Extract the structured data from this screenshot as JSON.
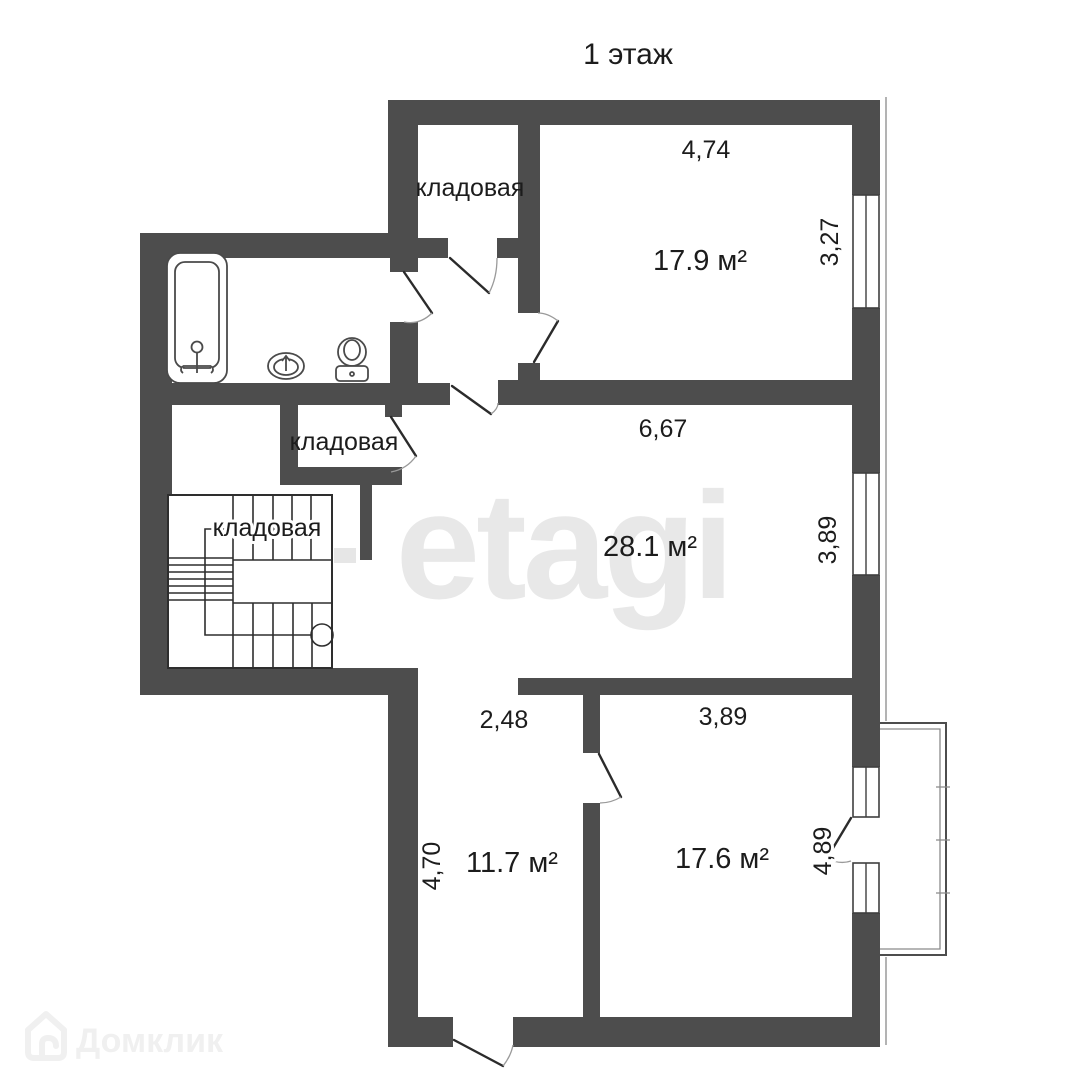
{
  "page": {
    "title": "1 этаж"
  },
  "plan": {
    "rooms": {
      "storage_top": {
        "label": "кладовая"
      },
      "storage_mid": {
        "label": "кладовая"
      },
      "storage_under_stairs": {
        "label": "кладовая"
      },
      "bedroom_top": {
        "area": "17.9 м²",
        "dim_width": "4,74",
        "dim_height": "3,27"
      },
      "hall": {
        "area": "28.1 м²",
        "dim_width": "6,67",
        "dim_height": "3,89"
      },
      "room_bottom_left": {
        "area": "11.7 м²",
        "dim_width": "2,48",
        "dim_height": "4,70"
      },
      "room_bottom_right": {
        "area": "17.6 м²",
        "dim_width": "3,89",
        "dim_height": "4,89"
      }
    },
    "colors": {
      "wall": "#4d4d4d",
      "text": "#1c1c1c"
    }
  },
  "watermarks": {
    "brand_center": "etagi",
    "brand_corner": "Домклик"
  }
}
